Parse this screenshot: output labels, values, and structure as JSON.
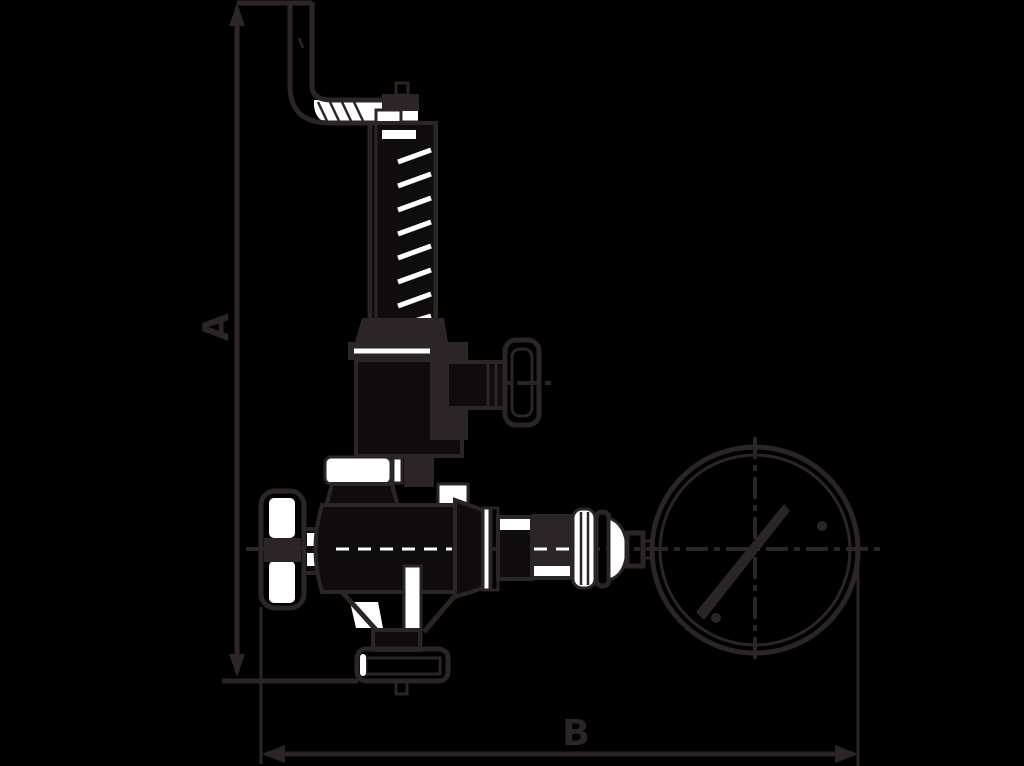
{
  "diagram": {
    "type": "technical-line-drawing",
    "subject": "relief valve with bracket, hand wheel and pressure gauge",
    "labels": {
      "dimension_a": "A",
      "dimension_b": "B"
    }
  },
  "colors": {
    "background": "#000000",
    "ink": "#2b2527",
    "highlight": "#ffffff",
    "darkfill": "#0e0c0d"
  }
}
